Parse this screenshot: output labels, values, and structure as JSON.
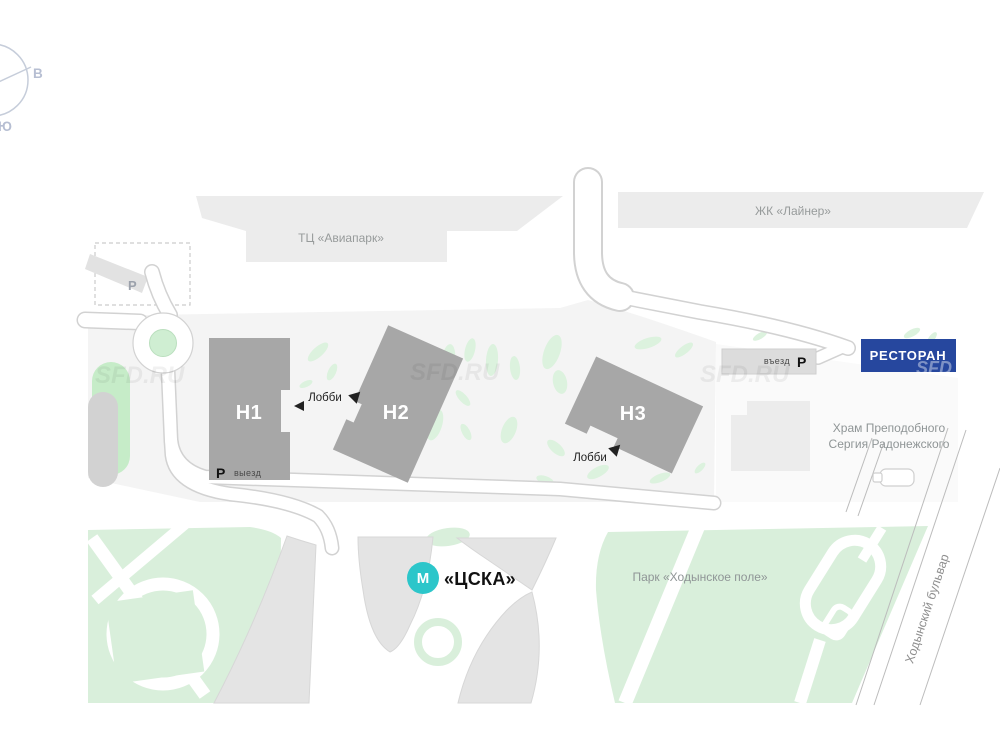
{
  "compass": {
    "east": "В",
    "south": "Ю"
  },
  "landmarks": {
    "aviapark": "ТЦ «Авиапарк»",
    "liner": "ЖК «Лайнер»",
    "church_line1": "Храм Преподобного",
    "church_line2": "Сергия Радонежского",
    "park": "Парк «Ходынское поле»",
    "boulevard": "Ходынский бульвар"
  },
  "buildings": {
    "h1": "Н1",
    "h2": "Н2",
    "h3": "Н3"
  },
  "lobby": {
    "label1": "Лобби",
    "label2": "Лобби"
  },
  "parking": {
    "area_p": "P",
    "entry_text": "въезд",
    "entry_p": "Р",
    "exit_p": "Р",
    "exit_text": "выезд"
  },
  "restaurant": {
    "label": "РЕСТОРАН"
  },
  "metro": {
    "letter": "М",
    "name": "«ЦСКА»"
  },
  "watermark": {
    "full": "SFD.RU",
    "short": "SFD"
  },
  "colors": {
    "restaurant_bg": "#26479E",
    "metro": "#2CC6CA",
    "building": "#A7A7A7",
    "light_building": "#ECECEC",
    "park_green": "#D9EFDB",
    "parcel": "#F4F4F4"
  }
}
